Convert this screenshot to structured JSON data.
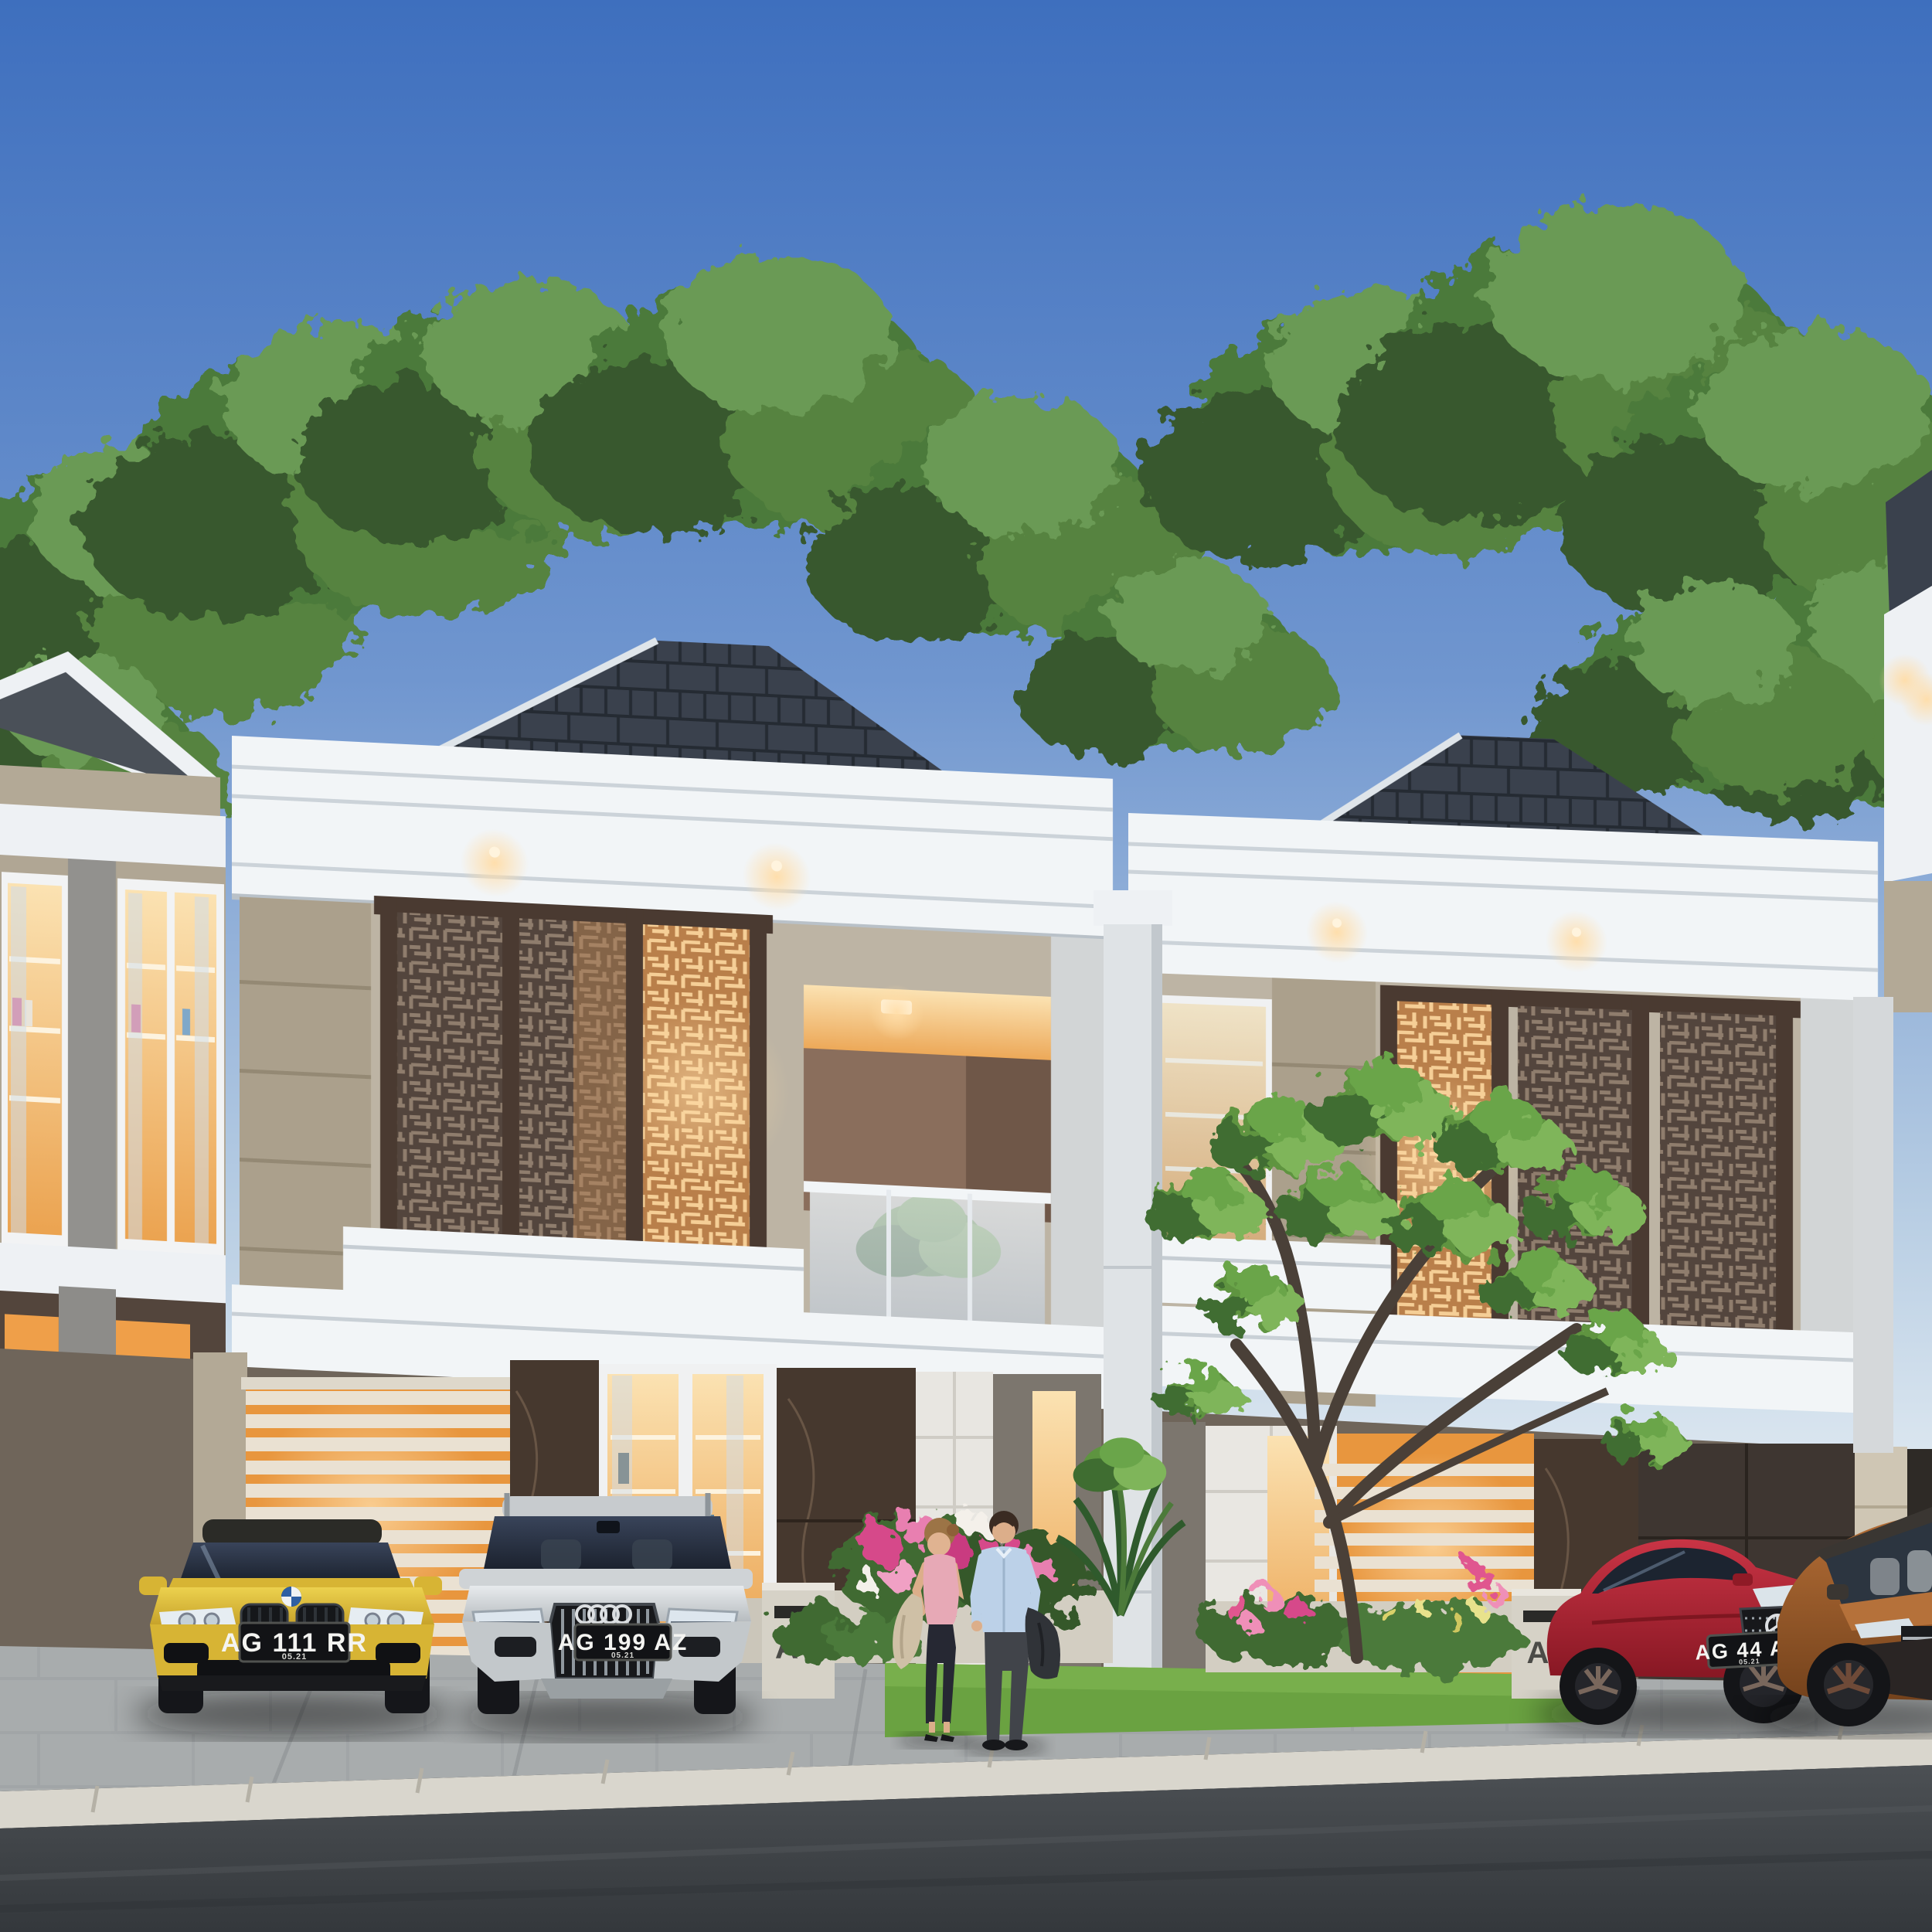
{
  "scene": {
    "type": "3d-architectural-exterior-render",
    "description": "Row of modern-classic two-storey townhouses at dusk with warm interior lighting, decorative laser-cut screen panels on the upper floor, white cornices, dark hip roofs, trees behind, parked cars and a couple standing on the driveway",
    "units_visible": [
      "A7",
      "A9"
    ]
  },
  "signs": {
    "a7": {
      "letter": "A",
      "number": "7"
    },
    "a9": {
      "letter": "A",
      "number": "9"
    }
  },
  "plates": {
    "bmw": {
      "text": "AG 111 RR",
      "expiry_small_text": "05.21"
    },
    "audi": {
      "text": "AG 199 AZ",
      "expiry_small_text": "05.21"
    },
    "mercedes": {
      "text": "AG 44 AN",
      "expiry_small_text": "05.21"
    }
  },
  "vehicles": [
    {
      "name": "yellow-bmw-coupe",
      "color": "#d7b434"
    },
    {
      "name": "silver-audi-wagon",
      "color": "#cfd3d6"
    },
    {
      "name": "red-mercedes-coupe",
      "color": "#a91e2c"
    },
    {
      "name": "bronze-suv",
      "color": "#96572b"
    }
  ],
  "people": [
    {
      "name": "woman",
      "top_color": "#e7a9b6",
      "pants_color": "#262833",
      "jacket_color": "#cfc0a6"
    },
    {
      "name": "man",
      "shirt_color": "#bcd1e8",
      "trousers_color": "#41444a",
      "jacket_color": "#303338"
    }
  ],
  "palette": {
    "sky_top": "#3e6fbe",
    "sky_horizon": "#e2ebf2",
    "roof": "#3a414d",
    "cornice_white": "#f2f5f7",
    "wall_stone": "#b9b0a0",
    "lattice_dark": "#53453d",
    "lattice_glow": "#c08a56",
    "warm_light": "#f2b869",
    "marble_dark": "#46382e",
    "tree_green": "#57833f",
    "grass": "#6aa241",
    "driveway": "#a8acad",
    "curb": "#d9d6cd",
    "road": "#42464a",
    "sign_letter": "#4b4b47",
    "sign_number": "#679a49",
    "plate_bg": "#121316"
  }
}
